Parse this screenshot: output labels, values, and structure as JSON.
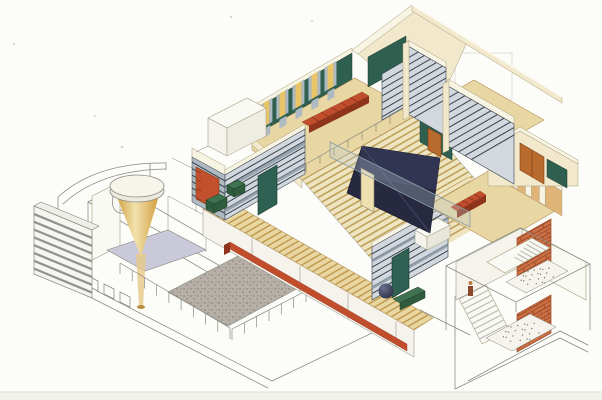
{
  "meta": {
    "subject": "Axonometric cutaway rendering of a modernist two-storey house with central grand staircase, louvered walls, gallery bridge, sunken court, light cone over circular skylight table, and brick entry stair tower",
    "style": "hand-colored architectural illustration on white paper"
  },
  "palette": {
    "paper": "#fcfcf9",
    "scanBand": "#f3f3ee",
    "scanLine": "#dddDD6",
    "outline": "#85897f",
    "edge": "#a79c7a",
    "edgeTan": "#b2945a",
    "white": "#fafaf4",
    "fascia": "#f5f3ec",
    "cream": "#f2e8cb",
    "creamL": "#f8f4e4",
    "tan": "#e9d7a3",
    "tanD": "#efe4c0",
    "treadLine": "#bfa05a",
    "walkStripe": "#c19a4f",
    "teal": "#2f5f4e",
    "tealDoor": "#2f6152",
    "winY": "#e7c568",
    "louvLight": "#d2d8dd",
    "louvMid": "#aeb9c2",
    "louvLine": "#39434e",
    "louvDeep": "#8d9aa6",
    "wood": "#b96b2e",
    "woodFr": "#7e3f16",
    "woodPanel": "#e0b377",
    "orangePanel": "#c3502c",
    "red": "#c04e2c",
    "redD": "#8f341c",
    "brick": "#cc7146",
    "brickL": "#9c4a26",
    "navy": "#272941",
    "navyL": "#3c3f5e",
    "lav": "#c9c9da",
    "courtBase": "#b6b0a8",
    "courtDot": "#837c72",
    "goldDark": "#cf9b38",
    "goldLight": "#f2e2ae",
    "goldBeam": "#e7c886",
    "glass": "#b8cdd8",
    "glassL": "#8a9aa5",
    "greenBox": "#2f5c3c",
    "greenBoxTop": "#3f7350",
    "sphereHi": "#6a7090",
    "sphereLo": "#23263a",
    "figure": "#8a4a2a",
    "figureHead": "#b97c4a"
  },
  "counts": {
    "clerestory_windows": 5,
    "grand_stair_treads": 22,
    "lower_stair_treads": 9,
    "walkway_stripes": 38,
    "upper_bench_segments": 6,
    "east_bench_segments": 5,
    "louver_lines_w1": 8,
    "louver_lines_w1_side": 6,
    "louver_lines_w2": 8,
    "louver_lines_va": 10,
    "louver_lines_vb": 11,
    "louver_lines_step": 6,
    "left_block_stripes": 8,
    "courtyard_rail_posts": 10,
    "courtyard_rail_posts_2": 7,
    "upper_rail_posts": 9,
    "tower_flight_a_treads": 7,
    "tower_flight_b_treads": 9,
    "fascia_joints": 4,
    "landing_dots": 26
  }
}
